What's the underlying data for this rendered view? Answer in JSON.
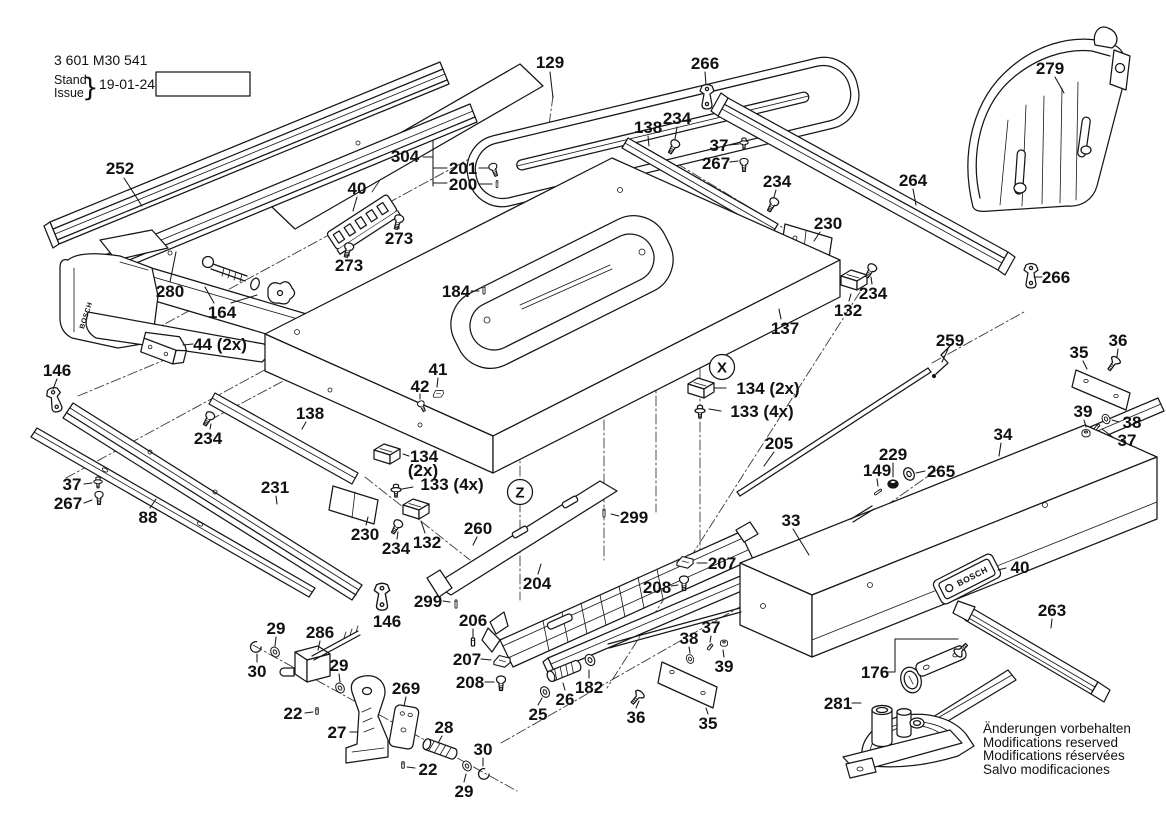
{
  "colors": {
    "ink": "#161616",
    "paper": "#ffffff"
  },
  "meta": {
    "part_number": "3 601 M30 541",
    "stand": "Stand",
    "issue": "Issue",
    "brace": "}",
    "date": "19-01-24",
    "fig_label": "Fig./Abb. 1"
  },
  "brand": {
    "name": "BOSCH"
  },
  "notes": [
    "Änderungen vorbehalten",
    "Modifications reserved",
    "Modifications réservées",
    "Salvo modificaciones"
  ],
  "callouts": [
    {
      "t": "X",
      "x": 722,
      "y": 367
    },
    {
      "t": "Z",
      "x": 520,
      "y": 492
    }
  ],
  "labels": [
    {
      "t": "252",
      "x": 120,
      "y": 168,
      "lead": [
        124,
        178,
        142,
        206
      ]
    },
    {
      "t": "280",
      "x": 170,
      "y": 291,
      "lead": [
        170,
        282,
        176,
        252
      ]
    },
    {
      "t": "164",
      "x": 222,
      "y": 312
    },
    {
      "t": "44 (2x)",
      "x": 220,
      "y": 344,
      "lead": [
        193,
        344,
        183,
        345
      ]
    },
    {
      "t": "146",
      "x": 57,
      "y": 370,
      "lead": [
        57,
        379,
        53,
        389
      ]
    },
    {
      "t": "129",
      "x": 550,
      "y": 62,
      "lead": [
        550,
        72,
        553,
        98
      ]
    },
    {
      "t": "304",
      "x": 405,
      "y": 156
    },
    {
      "t": "201",
      "x": 463,
      "y": 168,
      "lead": [
        479,
        168,
        488,
        168
      ]
    },
    {
      "t": "200",
      "x": 463,
      "y": 184,
      "lead": [
        479,
        184,
        492,
        184
      ]
    },
    {
      "t": "40",
      "x": 357,
      "y": 188,
      "lead": [
        357,
        197,
        353,
        211
      ]
    },
    {
      "t": "273",
      "x": 399,
      "y": 238,
      "lead": [
        399,
        229,
        399,
        224
      ]
    },
    {
      "t": "273",
      "x": 349,
      "y": 265,
      "lead": [
        349,
        256,
        349,
        252
      ]
    },
    {
      "t": "266",
      "x": 705,
      "y": 63,
      "lead": [
        705,
        72,
        706,
        85
      ]
    },
    {
      "t": "279",
      "x": 1050,
      "y": 68,
      "lead": [
        1055,
        77,
        1064,
        93
      ]
    },
    {
      "t": "138",
      "x": 648,
      "y": 127,
      "lead": [
        648,
        136,
        649,
        146
      ]
    },
    {
      "t": "234",
      "x": 677,
      "y": 118,
      "lead": [
        677,
        127,
        675,
        139
      ]
    },
    {
      "t": "37",
      "x": 719,
      "y": 145,
      "lead": [
        729,
        145,
        739,
        144
      ]
    },
    {
      "t": "267",
      "x": 716,
      "y": 163,
      "lead": [
        730,
        162,
        738,
        161
      ]
    },
    {
      "t": "234",
      "x": 777,
      "y": 181,
      "lead": [
        776,
        190,
        774,
        197
      ]
    },
    {
      "t": "264",
      "x": 913,
      "y": 180,
      "lead": [
        913,
        189,
        916,
        205
      ]
    },
    {
      "t": "266",
      "x": 1056,
      "y": 277,
      "lead": [
        1042,
        277,
        1034,
        277
      ]
    },
    {
      "t": "230",
      "x": 828,
      "y": 223,
      "lead": [
        820,
        232,
        814,
        241
      ]
    },
    {
      "t": "234",
      "x": 873,
      "y": 293,
      "lead": [
        872,
        284,
        871,
        277
      ]
    },
    {
      "t": "132",
      "x": 848,
      "y": 310,
      "lead": [
        849,
        301,
        851,
        294
      ]
    },
    {
      "t": "137",
      "x": 785,
      "y": 328,
      "lead": [
        781,
        319,
        779,
        309
      ]
    },
    {
      "t": "184",
      "x": 456,
      "y": 291,
      "lead": [
        471,
        291,
        479,
        291
      ]
    },
    {
      "t": "134 (2x)",
      "x": 768,
      "y": 388,
      "lead": [
        726,
        388,
        714,
        388
      ]
    },
    {
      "t": "133 (4x)",
      "x": 762,
      "y": 411,
      "lead": [
        721,
        411,
        709,
        409
      ]
    },
    {
      "t": "41",
      "x": 438,
      "y": 369,
      "lead": [
        438,
        378,
        437,
        387
      ]
    },
    {
      "t": "42",
      "x": 420,
      "y": 386,
      "lead": [
        420,
        394,
        420,
        399
      ]
    },
    {
      "t": "259",
      "x": 950,
      "y": 340,
      "lead": [
        948,
        349,
        942,
        362
      ]
    },
    {
      "t": "35",
      "x": 1079,
      "y": 352,
      "lead": [
        1083,
        361,
        1087,
        369
      ]
    },
    {
      "t": "36",
      "x": 1118,
      "y": 340,
      "lead": [
        1118,
        349,
        1117,
        357
      ]
    },
    {
      "t": "39",
      "x": 1083,
      "y": 411,
      "lead": [
        1084,
        420,
        1086,
        427
      ]
    },
    {
      "t": "38",
      "x": 1132,
      "y": 422,
      "lead": [
        1119,
        422,
        1112,
        420
      ]
    },
    {
      "t": "37",
      "x": 1127,
      "y": 440,
      "lead": [
        1114,
        438,
        1102,
        429
      ]
    },
    {
      "t": "34",
      "x": 1003,
      "y": 434,
      "lead": [
        1001,
        443,
        999,
        456
      ]
    },
    {
      "t": "229",
      "x": 893,
      "y": 454,
      "lead": [
        893,
        463,
        893,
        477
      ]
    },
    {
      "t": "149",
      "x": 877,
      "y": 470,
      "lead": [
        877,
        479,
        878,
        486
      ]
    },
    {
      "t": "265",
      "x": 941,
      "y": 471,
      "lead": [
        925,
        471,
        916,
        473
      ]
    },
    {
      "t": "205",
      "x": 779,
      "y": 443,
      "lead": [
        774,
        452,
        764,
        466
      ]
    },
    {
      "t": "33",
      "x": 791,
      "y": 520,
      "lead": [
        793,
        529,
        809,
        555
      ]
    },
    {
      "t": "138",
      "x": 310,
      "y": 413,
      "lead": [
        306,
        422,
        302,
        429
      ]
    },
    {
      "t": "234",
      "x": 208,
      "y": 438,
      "lead": [
        210,
        429,
        211,
        424
      ]
    },
    {
      "t": "134",
      "x": 424,
      "y": 456,
      "lead": [
        409,
        456,
        403,
        454
      ]
    },
    {
      "t": "(2x)",
      "x": 423,
      "y": 470
    },
    {
      "t": "133 (4x)",
      "x": 452,
      "y": 484,
      "lead": [
        413,
        487,
        402,
        489
      ]
    },
    {
      "t": "37",
      "x": 72,
      "y": 484,
      "lead": [
        84,
        484,
        92,
        483
      ]
    },
    {
      "t": "267",
      "x": 68,
      "y": 503,
      "lead": [
        84,
        503,
        92,
        500
      ]
    },
    {
      "t": "88",
      "x": 148,
      "y": 517,
      "lead": [
        150,
        508,
        156,
        499
      ]
    },
    {
      "t": "231",
      "x": 275,
      "y": 487,
      "lead": [
        276,
        496,
        277,
        504
      ]
    },
    {
      "t": "230",
      "x": 365,
      "y": 534,
      "lead": [
        366,
        525,
        368,
        517
      ]
    },
    {
      "t": "234",
      "x": 396,
      "y": 548,
      "lead": [
        397,
        539,
        398,
        532
      ]
    },
    {
      "t": "132",
      "x": 427,
      "y": 542,
      "lead": [
        425,
        533,
        421,
        521
      ]
    },
    {
      "t": "146",
      "x": 387,
      "y": 621
    },
    {
      "t": "299",
      "x": 428,
      "y": 601,
      "lead": [
        443,
        601,
        450,
        602
      ]
    },
    {
      "t": "260",
      "x": 478,
      "y": 528,
      "lead": [
        477,
        537,
        473,
        545
      ]
    },
    {
      "t": "299",
      "x": 634,
      "y": 517,
      "lead": [
        619,
        516,
        611,
        514
      ]
    },
    {
      "t": "204",
      "x": 537,
      "y": 583,
      "lead": [
        538,
        574,
        541,
        564
      ]
    },
    {
      "t": "206",
      "x": 473,
      "y": 620,
      "lead": [
        473,
        629,
        473,
        637
      ]
    },
    {
      "t": "207",
      "x": 467,
      "y": 659,
      "lead": [
        481,
        659,
        491,
        660
      ]
    },
    {
      "t": "208",
      "x": 470,
      "y": 682,
      "lead": [
        485,
        682,
        494,
        682
      ]
    },
    {
      "t": "207",
      "x": 722,
      "y": 563,
      "lead": [
        707,
        563,
        697,
        563
      ]
    },
    {
      "t": "208",
      "x": 657,
      "y": 587,
      "lead": [
        671,
        586,
        678,
        585
      ]
    },
    {
      "t": "25",
      "x": 538,
      "y": 714,
      "lead": [
        538,
        705,
        542,
        698
      ]
    },
    {
      "t": "26",
      "x": 565,
      "y": 699,
      "lead": [
        565,
        690,
        563,
        683
      ]
    },
    {
      "t": "182",
      "x": 589,
      "y": 687,
      "lead": [
        589,
        678,
        589,
        670
      ]
    },
    {
      "t": "36",
      "x": 636,
      "y": 717,
      "lead": [
        636,
        708,
        639,
        701
      ]
    },
    {
      "t": "35",
      "x": 708,
      "y": 723,
      "lead": [
        708,
        714,
        706,
        708
      ]
    },
    {
      "t": "38",
      "x": 689,
      "y": 638,
      "lead": [
        689,
        647,
        690,
        653
      ]
    },
    {
      "t": "37",
      "x": 711,
      "y": 627,
      "lead": [
        711,
        636,
        710,
        642
      ]
    },
    {
      "t": "39",
      "x": 724,
      "y": 666,
      "lead": [
        724,
        657,
        723,
        650
      ]
    },
    {
      "t": "29",
      "x": 276,
      "y": 628,
      "lead": [
        276,
        637,
        275,
        646
      ]
    },
    {
      "t": "286",
      "x": 320,
      "y": 632,
      "lead": [
        320,
        641,
        318,
        650
      ]
    },
    {
      "t": "30",
      "x": 257,
      "y": 671,
      "lead": [
        257,
        662,
        257,
        654
      ]
    },
    {
      "t": "29",
      "x": 339,
      "y": 665,
      "lead": [
        339,
        674,
        340,
        682
      ]
    },
    {
      "t": "22",
      "x": 293,
      "y": 713,
      "lead": [
        305,
        713,
        313,
        712
      ]
    },
    {
      "t": "27",
      "x": 337,
      "y": 732,
      "lead": [
        350,
        732,
        358,
        732
      ]
    },
    {
      "t": "269",
      "x": 406,
      "y": 688,
      "lead": [
        406,
        697,
        404,
        706
      ]
    },
    {
      "t": "28",
      "x": 444,
      "y": 727,
      "lead": [
        442,
        736,
        438,
        743
      ]
    },
    {
      "t": "22",
      "x": 428,
      "y": 769,
      "lead": [
        415,
        768,
        407,
        767
      ]
    },
    {
      "t": "30",
      "x": 483,
      "y": 749,
      "lead": [
        483,
        758,
        483,
        766
      ]
    },
    {
      "t": "29",
      "x": 464,
      "y": 791,
      "lead": [
        464,
        782,
        466,
        774
      ]
    },
    {
      "t": "176",
      "x": 875,
      "y": 672
    },
    {
      "t": "281",
      "x": 838,
      "y": 703,
      "lead": [
        852,
        703,
        861,
        703
      ]
    },
    {
      "t": "40",
      "x": 1020,
      "y": 567,
      "lead": [
        1006,
        568,
        998,
        570
      ]
    },
    {
      "t": "263",
      "x": 1052,
      "y": 610,
      "lead": [
        1052,
        619,
        1051,
        628
      ]
    }
  ]
}
